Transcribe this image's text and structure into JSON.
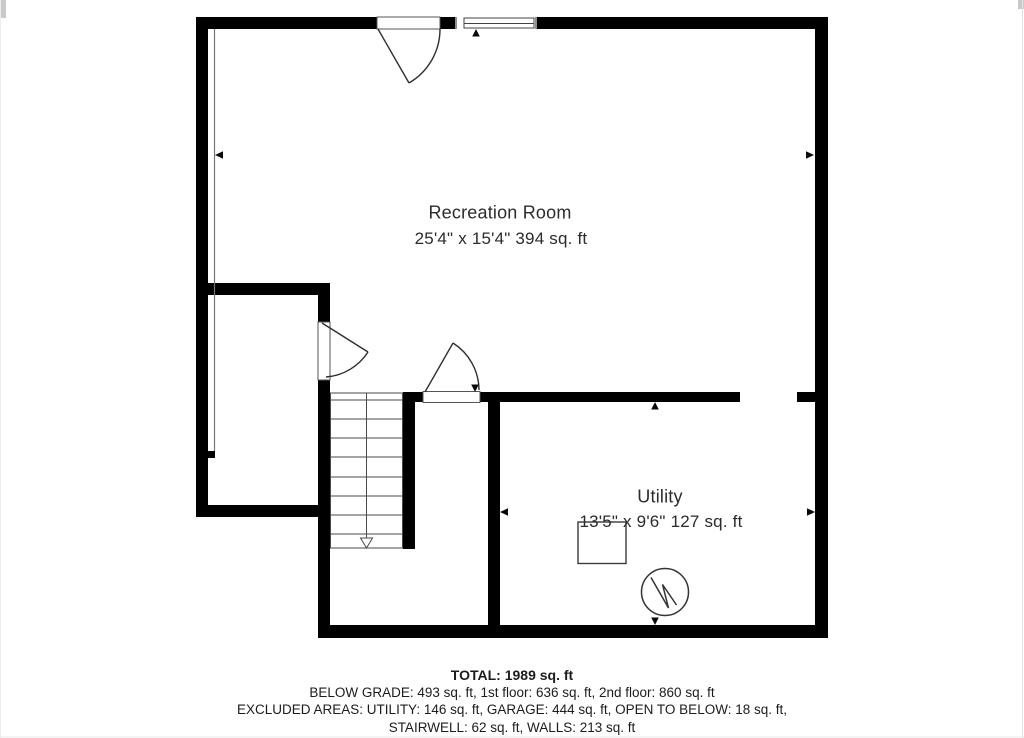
{
  "plan": {
    "rooms": [
      {
        "name": "Recreation Room",
        "dimensions": "25'4\" x 15'4\" 394 sq. ft"
      },
      {
        "name": "Utility",
        "dimensions": "13'5\" x 9'6\" 127 sq. ft"
      }
    ],
    "summary": {
      "total": "TOTAL: 1989 sq. ft",
      "line1": "BELOW GRADE: 493 sq. ft, 1st floor: 636 sq. ft, 2nd floor: 860 sq. ft",
      "line2": "EXCLUDED AREAS: UTILITY: 146 sq. ft, GARAGE: 444 sq. ft, OPEN TO BELOW: 18 sq. ft,",
      "line3": "STAIRWELL: 62 sq. ft, WALLS: 213 sq. ft"
    },
    "colors": {
      "wall": "#000000",
      "thin_line": "#4a4a4a",
      "text": "#2b2b2b"
    }
  }
}
